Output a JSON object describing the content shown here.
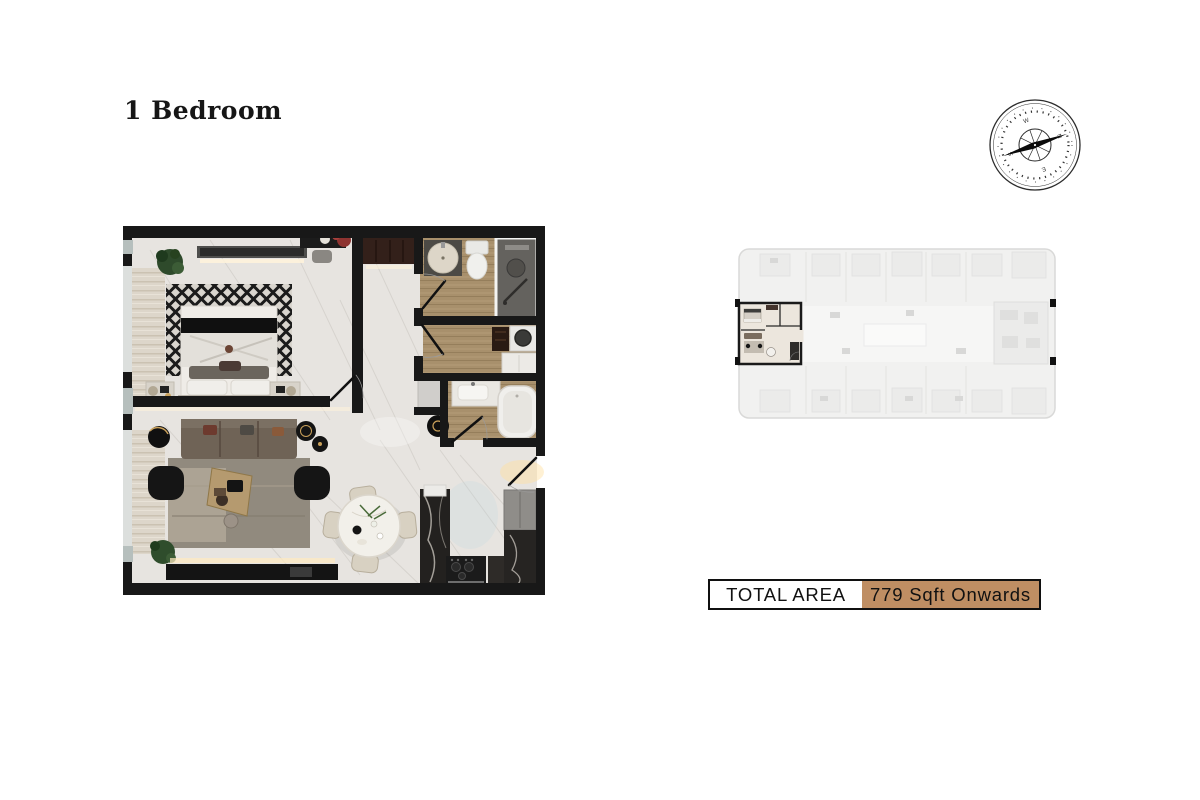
{
  "title": "1 Bedroom",
  "total_area": {
    "label": "TOTAL AREA",
    "value": "779 Sqft Onwards"
  },
  "colors": {
    "accent_tan": "#bf8e63",
    "wall_black": "#181818",
    "marble_floor": "#e7e4e0",
    "wood_floor": "#a8906c",
    "keyplan_gray": "#f1f1f0"
  },
  "compass": {
    "letters": [
      "N",
      "E",
      "S",
      "W"
    ]
  },
  "floor_plan": {
    "rooms": [
      {
        "name": "bedroom",
        "furniture": [
          "bed",
          "diamond-rug",
          "nightstand-left",
          "nightstand-right",
          "plant",
          "tv-console",
          "vanity-desk"
        ]
      },
      {
        "name": "bathroom-1",
        "furniture": [
          "round-basin",
          "toilet",
          "walk-in-shower",
          "door"
        ]
      },
      {
        "name": "dressing-room",
        "furniture": [
          "washer",
          "shelf",
          "cabinet",
          "door"
        ]
      },
      {
        "name": "bathroom-2",
        "furniture": [
          "sink-counter",
          "bathtub",
          "door"
        ]
      },
      {
        "name": "living-room",
        "furniture": [
          "sofa",
          "armchair-left",
          "armchair-right",
          "coffee-table",
          "rug",
          "side-tables",
          "plant",
          "media-console"
        ]
      },
      {
        "name": "dining-area",
        "furniture": [
          "round-table",
          "chairs"
        ]
      },
      {
        "name": "kitchen",
        "furniture": [
          "island",
          "stove",
          "fridge-cabinet",
          "counter"
        ]
      },
      {
        "name": "corridor",
        "furniture": [
          "wardrobe",
          "round-side-table",
          "entry-door"
        ]
      }
    ]
  },
  "key_plan": {
    "highlighted_unit": "1 Bedroom unit",
    "position": "left-center"
  }
}
